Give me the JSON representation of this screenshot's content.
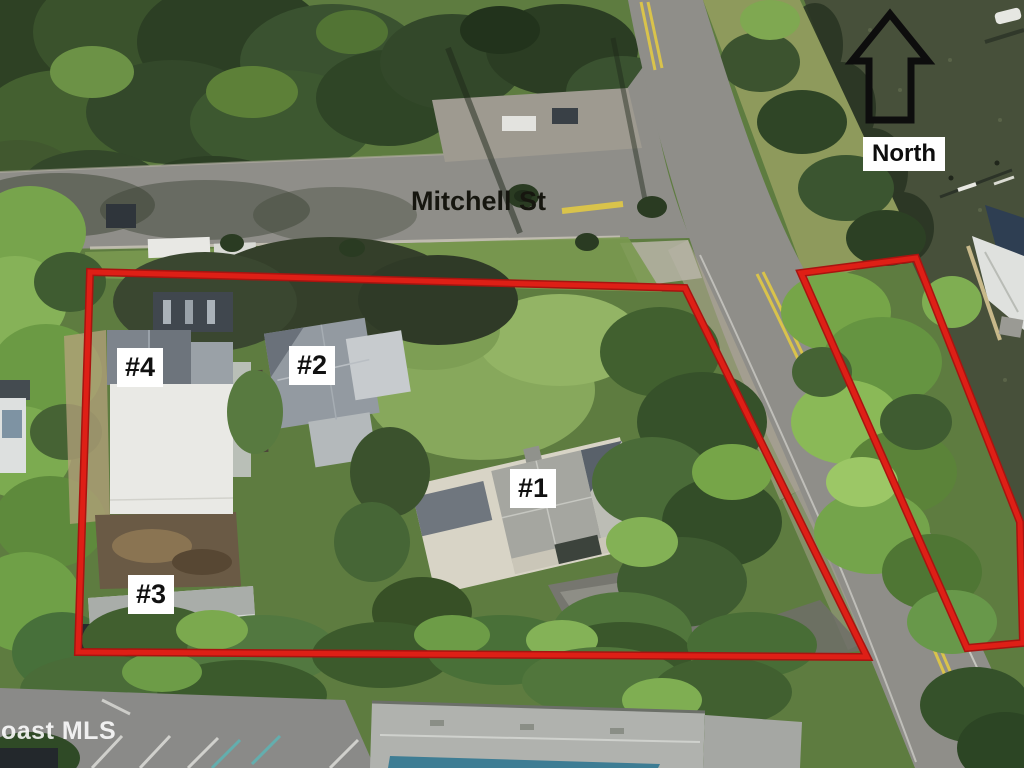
{
  "annotations": {
    "street_label": "Mitchell St",
    "compass_label": "North",
    "watermark": "oast MLS",
    "unit_labels": [
      {
        "id": "unit-1",
        "label": "#1"
      },
      {
        "id": "unit-2",
        "label": "#2"
      },
      {
        "id": "unit-3",
        "label": "#3"
      },
      {
        "id": "unit-4",
        "label": "#4"
      }
    ]
  },
  "colors": {
    "boundary-red": "#de1f16",
    "label-bg": "#ffffff",
    "label-text": "#111111",
    "water": "#47503a",
    "road": "#8f8e89",
    "lane-yellow": "#d9c34b"
  }
}
